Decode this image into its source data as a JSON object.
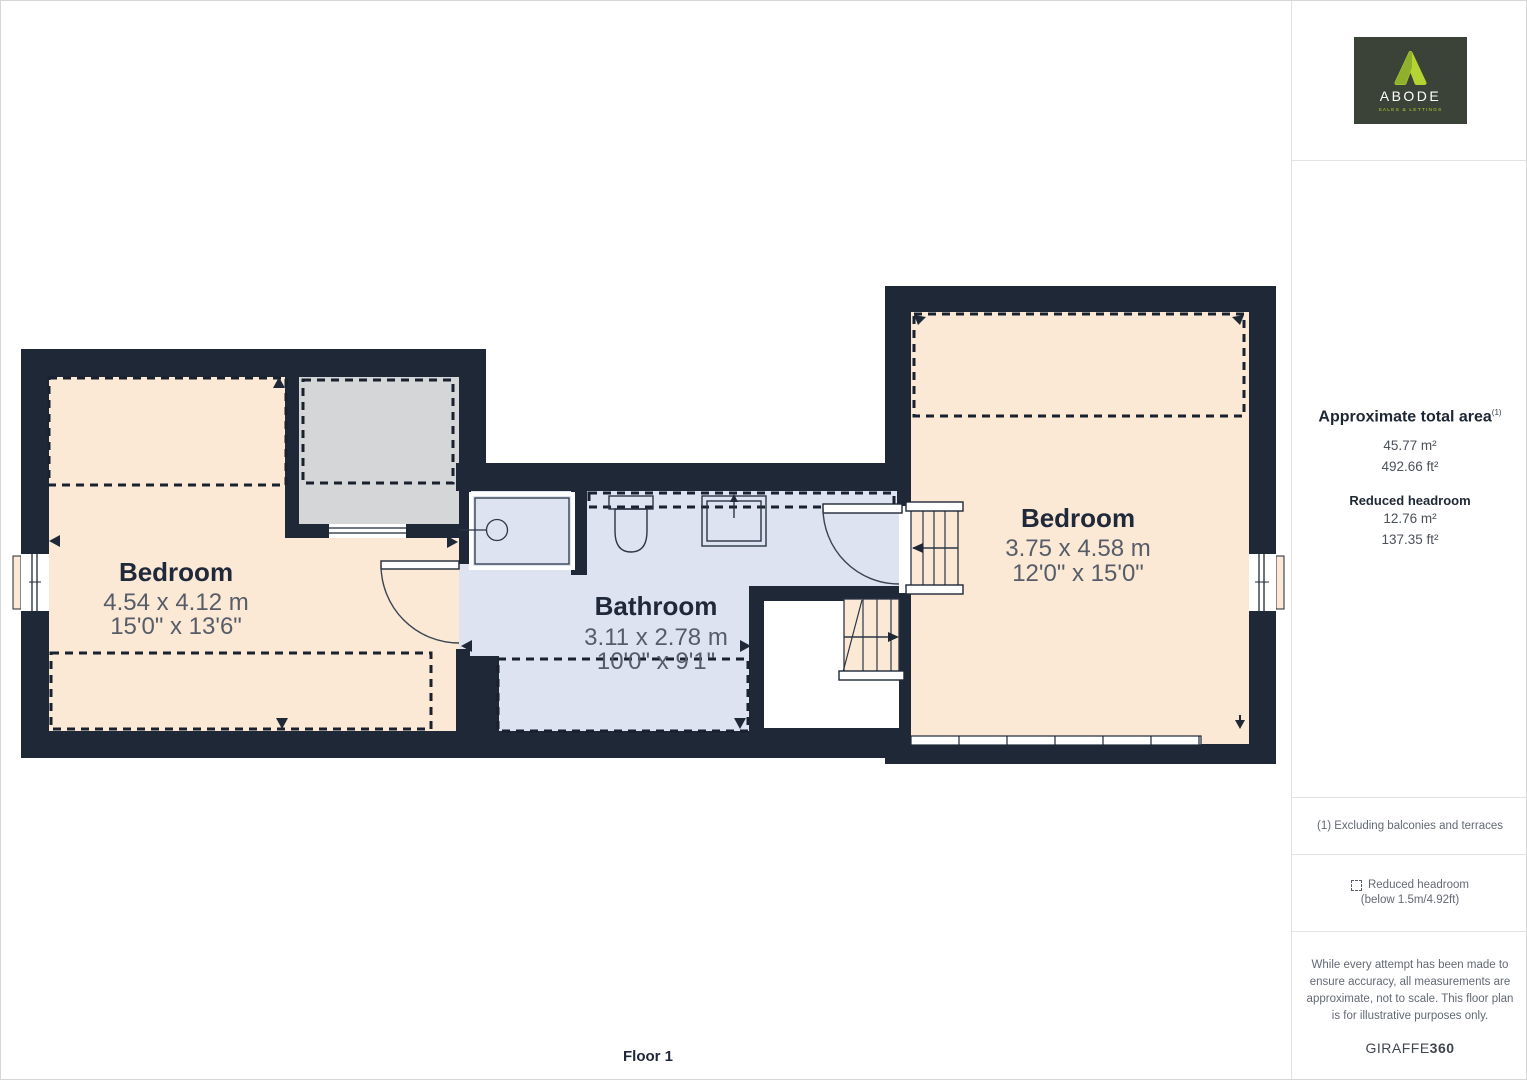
{
  "plan": {
    "floor_label": "Floor 1",
    "rooms": [
      {
        "id": "bedroom-left",
        "name": "Bedroom",
        "metric": "4.54 x 4.12 m",
        "imperial": "15'0\" x 13'6\""
      },
      {
        "id": "bathroom",
        "name": "Bathroom",
        "metric": "3.11 x 2.78 m",
        "imperial": "10'0\" x 9'1\""
      },
      {
        "id": "bedroom-right",
        "name": "Bedroom",
        "metric": "3.75 x 4.58 m",
        "imperial": "12'0\" x 15'0\""
      }
    ],
    "colors": {
      "wall": "#1f2836",
      "bedroom_fill": "#fbe9d6",
      "bathroom_fill": "#dde3f0",
      "reduced_room_fill": "#d5d6d8"
    }
  },
  "sidebar": {
    "logo": {
      "brand": "ABODE",
      "tagline": "SALES & LETTINGS",
      "bg": "#3b4237",
      "accent": "#b5d333"
    },
    "area": {
      "title": "Approximate total area",
      "footnote_ref": "(1)",
      "total_m2": "45.77 m²",
      "total_ft2": "492.66 ft²",
      "reduced_label": "Reduced headroom",
      "reduced_m2": "12.76 m²",
      "reduced_ft2": "137.35 ft²"
    },
    "footnote": "(1) Excluding balconies and terraces",
    "legend": {
      "label": "Reduced headroom",
      "detail": "(below 1.5m/4.92ft)"
    },
    "disclaimer": "While every attempt has been made to ensure accuracy, all measurements are approximate, not to scale. This floor plan is for illustrative purposes only.",
    "watermark": {
      "name": "GIRAFFE",
      "suffix": "360"
    }
  }
}
